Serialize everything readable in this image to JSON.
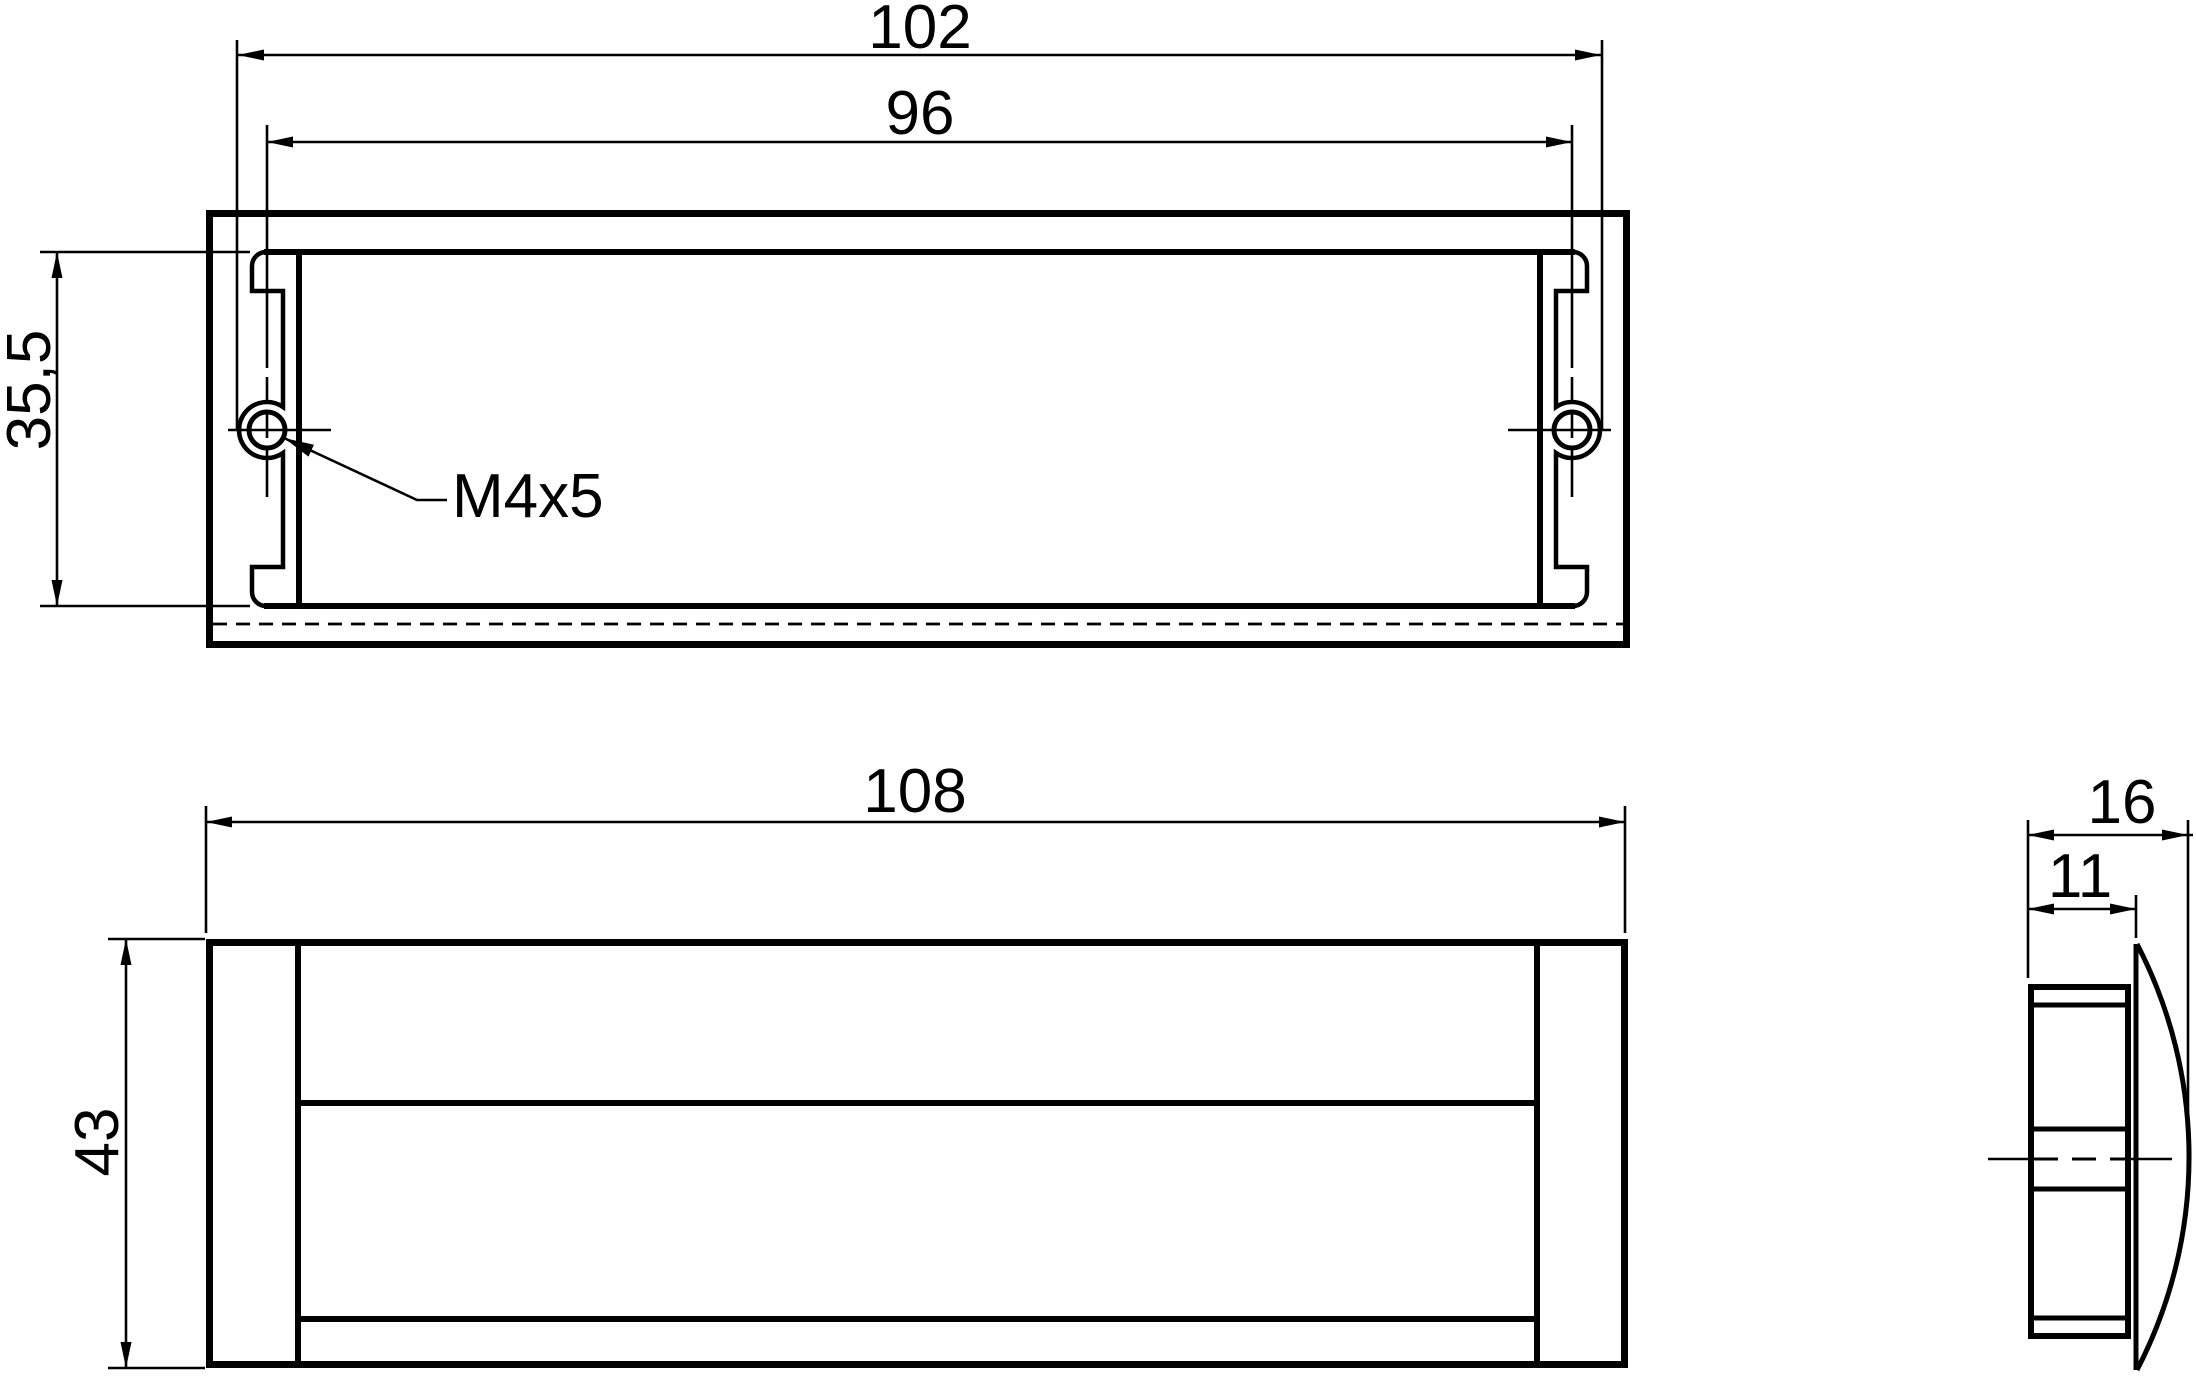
{
  "colors": {
    "line": "#000000",
    "background": "#ffffff"
  },
  "dimensions": {
    "top_view": {
      "outer_width": "102",
      "hole_spacing": "96",
      "cutout_height": "35,5",
      "thread_callout": "M4x5"
    },
    "front_view": {
      "overall_width": "108",
      "overall_height": "43"
    },
    "side_view": {
      "overall_depth": "16",
      "body_depth": "11"
    }
  }
}
